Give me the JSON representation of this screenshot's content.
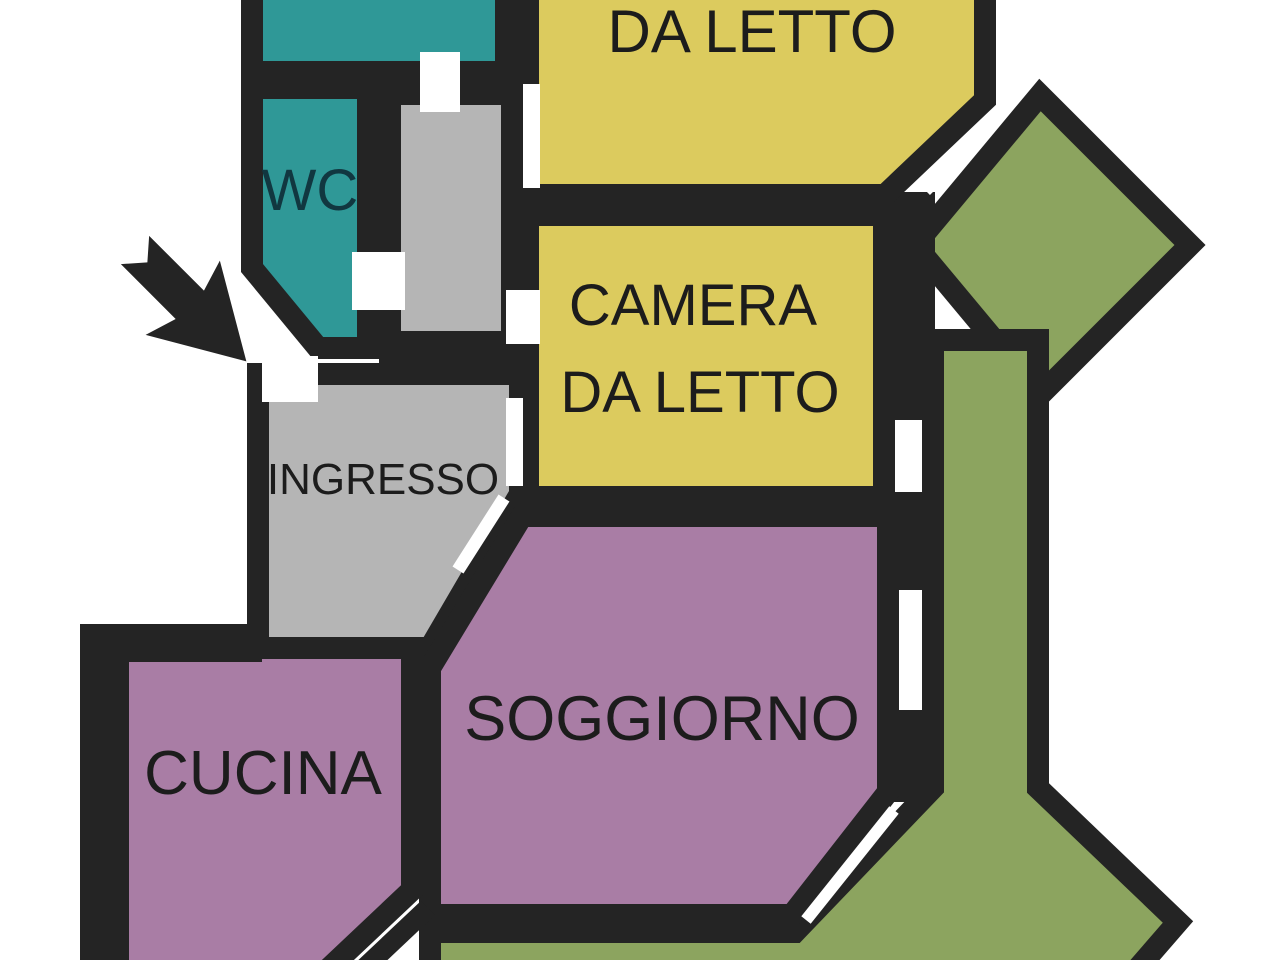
{
  "floorplan": {
    "type": "apartment floor plan",
    "labels": {
      "bedroom_top": "DA LETTO",
      "wc": "WC",
      "bedroom_main_line1": "CAMERA",
      "bedroom_main_line2": "DA LETTO",
      "entrance": "INGRESSO",
      "living_room": "SOGGIORNO",
      "kitchen": "CUCINA"
    },
    "colors": {
      "background": "#FFFFFF",
      "wall": "#242424",
      "bathroom_teal": "#2F9897",
      "bedroom_yellow": "#DCCB5E",
      "hallway_gray": "#B5B5B5",
      "living_purple": "#A97DA5",
      "balcony_green": "#8CA45F",
      "door_gap": "#FFFFFF",
      "label_text": "#1C1C1C",
      "wc_text": "#113740"
    }
  }
}
